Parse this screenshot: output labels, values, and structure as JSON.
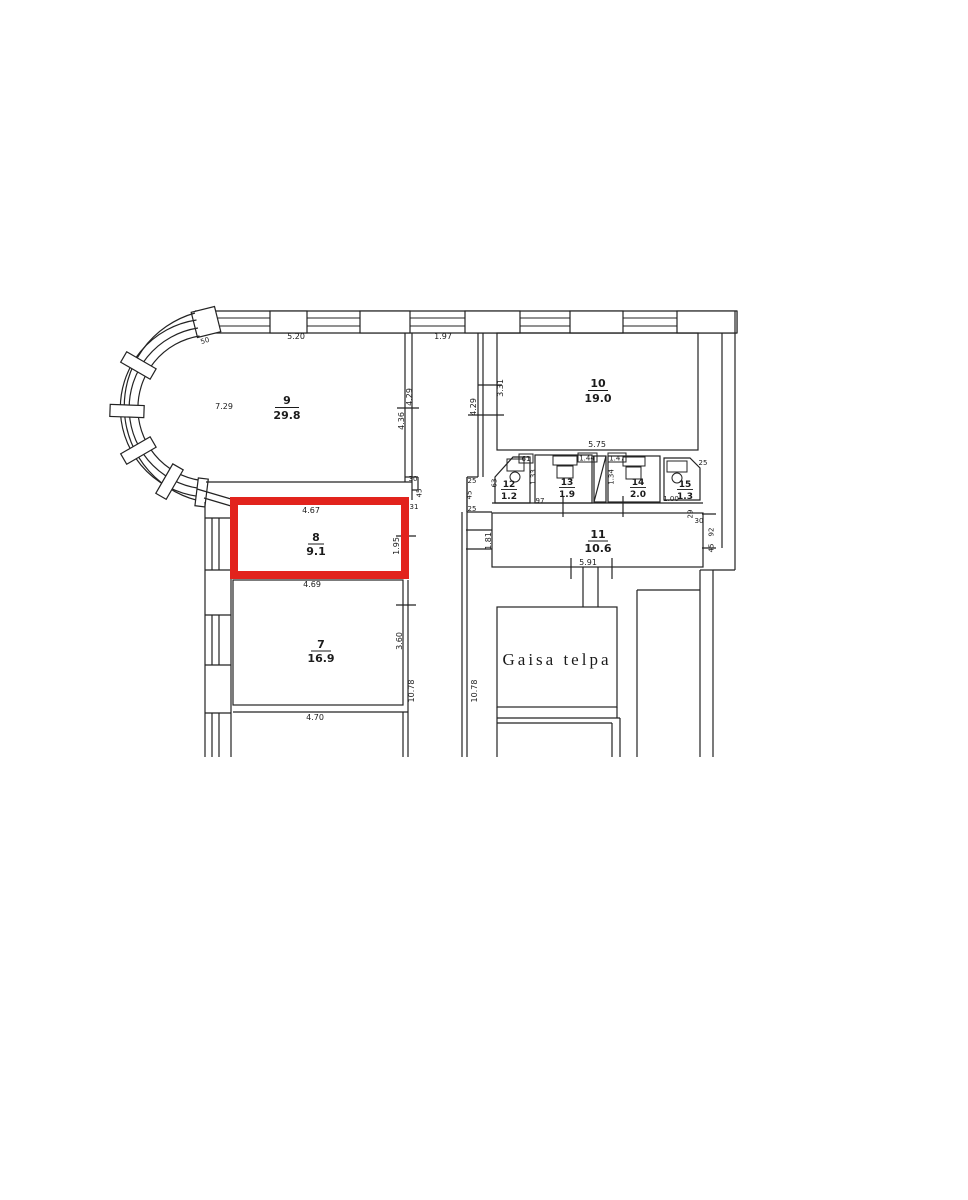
{
  "plan": {
    "highlight_color": "#e2231d",
    "line_color": "#232323"
  },
  "rooms": {
    "room7": {
      "number": "7",
      "area": "16.9"
    },
    "room8": {
      "number": "8",
      "area": "9.1"
    },
    "room9": {
      "number": "9",
      "area": "29.8"
    },
    "room10": {
      "number": "10",
      "area": "19.0"
    },
    "room11": {
      "number": "11",
      "area": "10.6"
    },
    "room12": {
      "number": "12",
      "area": "1.2"
    },
    "room13": {
      "number": "13",
      "area": "1.9"
    },
    "room14": {
      "number": "14",
      "area": "2.0"
    },
    "room15": {
      "number": "15",
      "area": "1.3"
    },
    "air_space": {
      "label": "Gaisa telpa"
    }
  },
  "dims": {
    "d_520": "5.20",
    "d_197": "1.97",
    "d_729": "7.29",
    "d_429a": "4.29",
    "d_436": "4.36",
    "d_331": "3.31",
    "d_429b": "4.29",
    "d_575": "5.75",
    "d_50": "50",
    "d_30a": "30",
    "d_45a": "45",
    "d_31": "31",
    "d_25a": "25",
    "d_45b": "45",
    "d_25b": "25",
    "d_61": "61",
    "d_63": "63",
    "d_133": "1.33",
    "d_144": "1.44",
    "d_97": "97",
    "d_147": "1.47",
    "d_134": "1.34",
    "d_100": "1.00",
    "d_25c": "25",
    "d_29": "29",
    "d_30b": "30",
    "d_92": "92",
    "d_45c": "45",
    "d_181": "1.81",
    "d_591": "5.91",
    "d_467": "4.67",
    "d_195": "1.95",
    "d_469": "4.69",
    "d_360": "3.60",
    "d_1078a": "10.78",
    "d_1078b": "10.78",
    "d_470": "4.70"
  }
}
